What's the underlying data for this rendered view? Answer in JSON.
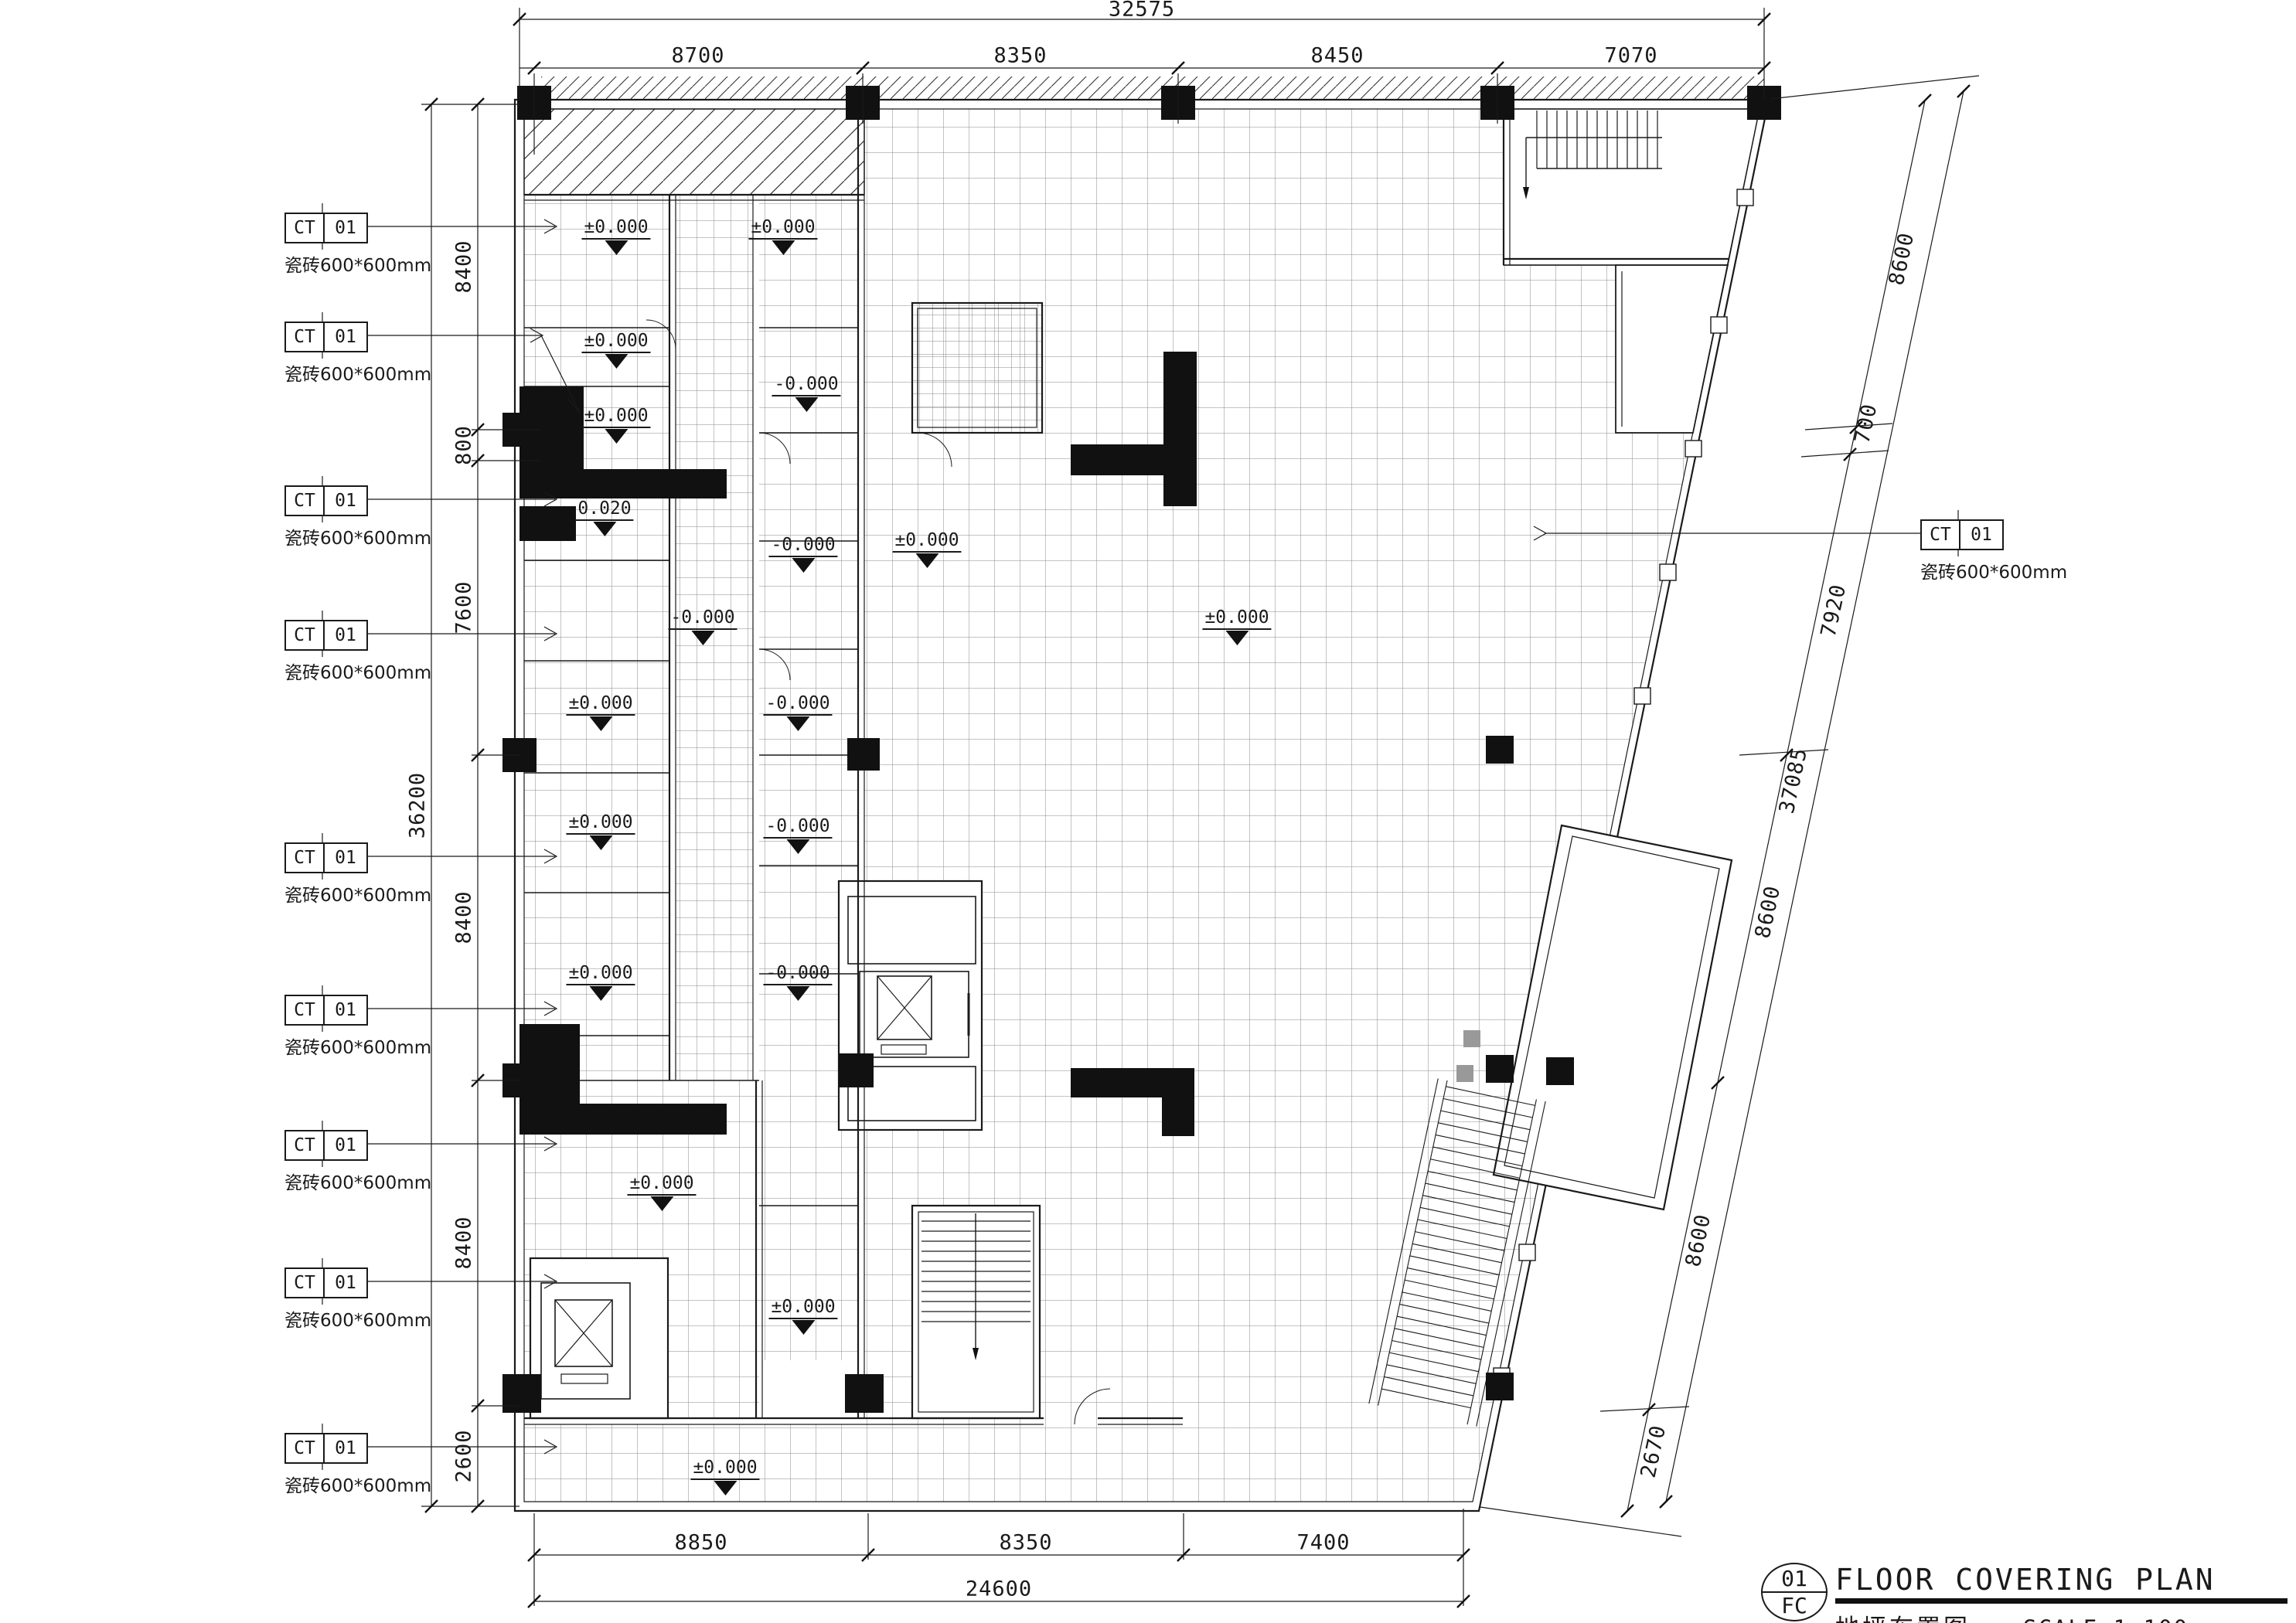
{
  "title_block": {
    "number": "01",
    "discipline": "FC",
    "title_en": "FLOOR COVERING PLAN",
    "title_cn": "地坪布置图",
    "scale": "SCALE 1:100"
  },
  "finish_tag": {
    "code": "CT",
    "number": "01",
    "description": "瓷砖600*600mm"
  },
  "dimensions": {
    "top": {
      "overall": "32575",
      "segments": [
        "8700",
        "8350",
        "8450",
        "7070"
      ]
    },
    "left": {
      "overall": "36200",
      "segments": [
        "8400",
        "800",
        "7600",
        "8400",
        "8400",
        "2600"
      ]
    },
    "bottom": {
      "overall": "24600",
      "segments": [
        "8850",
        "8350",
        "7400"
      ]
    },
    "right": {
      "overall": "37085",
      "segments": [
        "8600",
        "700",
        "7920",
        "8600",
        "8600",
        "2670"
      ]
    }
  },
  "levels": [
    "±0.000",
    "±0.000",
    "±0.000",
    "-0.000",
    "±0.000",
    "0.020",
    "±0.000",
    "-0.000",
    "-0.000",
    "±0.000",
    "±0.000",
    "-0.000",
    "±0.000",
    "-0.000",
    "±0.000",
    "-0.000",
    "±0.000",
    "±0.000",
    "±0.000"
  ]
}
